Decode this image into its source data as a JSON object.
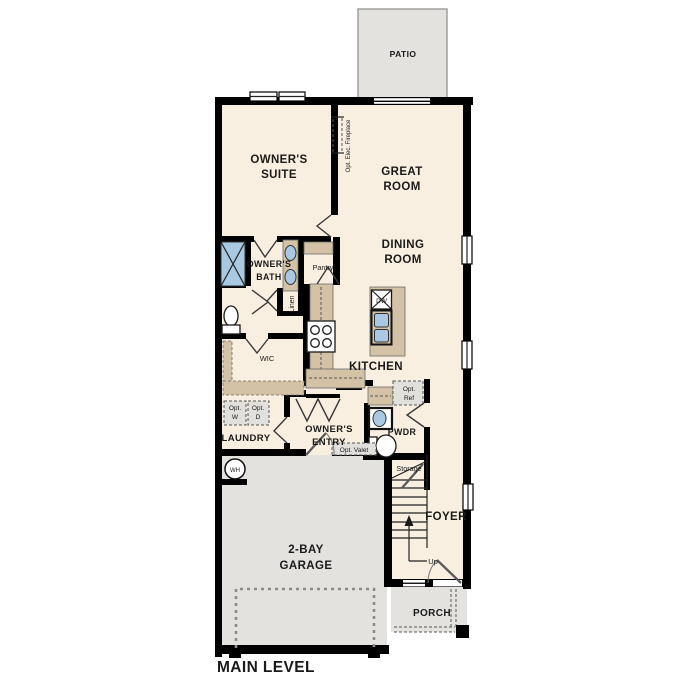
{
  "plan": {
    "title": "MAIN LEVEL",
    "patio": {
      "label": "PATIO"
    },
    "owners_suite": {
      "l1": "OWNER'S",
      "l2": "SUITE"
    },
    "great_room": {
      "l1": "GREAT",
      "l2": "ROOM"
    },
    "dining_room": {
      "l1": "DINING",
      "l2": "ROOM"
    },
    "kitchen": {
      "label": "KITCHEN",
      "island": {
        "dishwasher": "DW"
      }
    },
    "fireplace": {
      "label": "Opt. Elec. Fireplace"
    },
    "owners_bath": {
      "l1": "OWNER'S",
      "l2": "BATH"
    },
    "pantry": {
      "label": "Pantry"
    },
    "linen": {
      "label": "Linen"
    },
    "wic": {
      "label": "WIC"
    },
    "laundry": {
      "label": "LAUNDRY",
      "washer": {
        "l1": "Opt.",
        "l2": "W"
      },
      "dryer": {
        "l1": "Opt.",
        "l2": "D"
      }
    },
    "owners_entry": {
      "l1": "OWNER'S",
      "l2": "ENTRY",
      "valet": "Opt. Valet"
    },
    "powder": {
      "label": "PWDR"
    },
    "ref": {
      "l1": "Opt.",
      "l2": "Ref"
    },
    "storage": {
      "label": "Storage"
    },
    "stairs": {
      "up": "Up"
    },
    "foyer": {
      "label": "FOYER"
    },
    "garage": {
      "l1": "2-BAY",
      "l2": "GARAGE",
      "water_heater": "WH"
    },
    "porch": {
      "label": "PORCH"
    }
  },
  "colors": {
    "floor": "#f9efe0",
    "hardscape": "#e3e2de",
    "cabinet": "#d3c2a6",
    "fixture_blue": "#a9c8e2",
    "wall": "#000000"
  }
}
